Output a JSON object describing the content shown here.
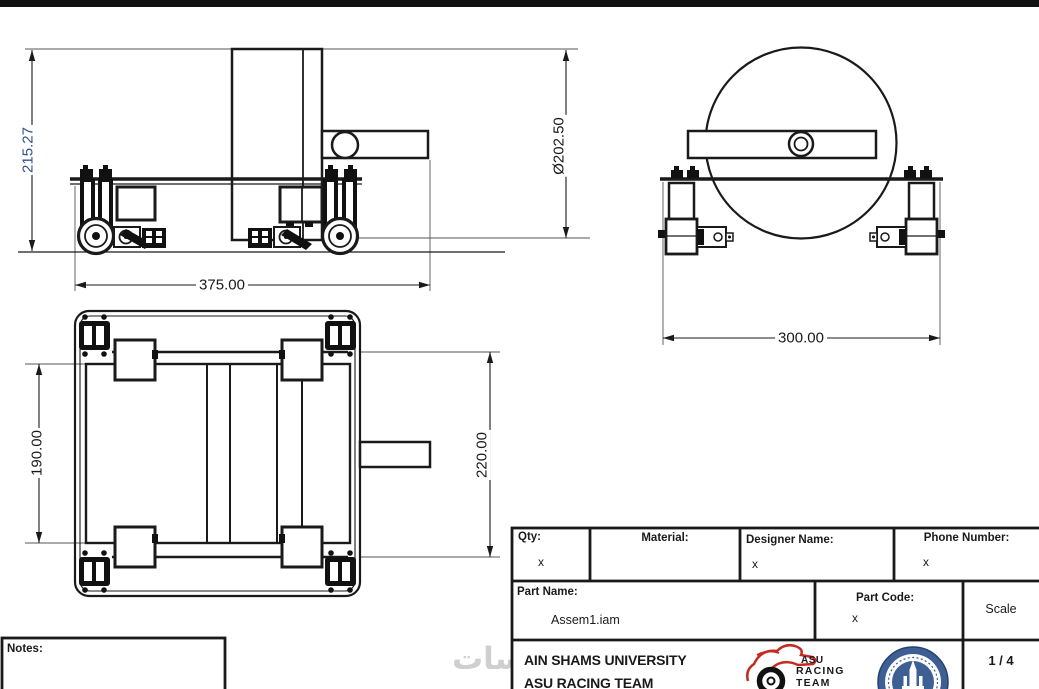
{
  "drawing": {
    "dimensions": {
      "side_height": "215.27",
      "wheel_diameter": "Ø202.50",
      "base_width": "375.00",
      "track_width": "300.00",
      "frame_length": "190.00",
      "overall_length": "220.00"
    },
    "notes_label": "Notes:"
  },
  "watermark": {
    "text": "خمسات"
  },
  "title_block": {
    "qty": {
      "label": "Qty:",
      "value": "x"
    },
    "material": {
      "label": "Material:",
      "value": ""
    },
    "designer": {
      "label": "Designer Name:",
      "value": "x"
    },
    "phone": {
      "label": "Phone Number:",
      "value": "x"
    },
    "part_name": {
      "label": "Part Name:",
      "value": "Assem1.iam"
    },
    "part_code": {
      "label": "Part Code:",
      "value": "x"
    },
    "scale": {
      "label": "Scale",
      "value": "1 / 4"
    },
    "organization": {
      "line1": "AIN SHAMS UNIVERSITY",
      "line2": "ASU RACING TEAM"
    },
    "racing_logo": {
      "line1": "ASU",
      "line2": "RACING",
      "line3": "TEAM"
    }
  },
  "colors": {
    "line": "#1a1a1a",
    "highlight_dim": "#33518e",
    "logo_red": "#c42a21",
    "emblem_blue": "#3d5f94",
    "watermark_gray": "#cfcfcf"
  }
}
